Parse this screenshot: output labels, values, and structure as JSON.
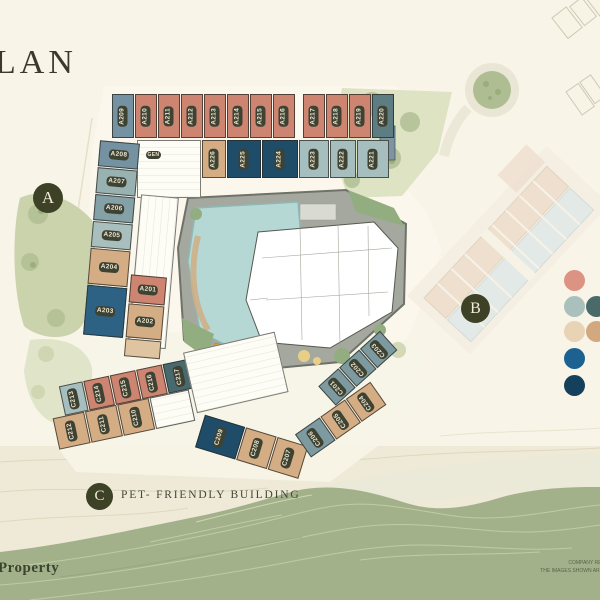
{
  "title": {
    "cropped_text": "LAN"
  },
  "brand": {
    "text": "Property"
  },
  "disclaimer": {
    "line1": "COMPANY RESERVES THE",
    "line2": "THE IMAGES SHOWN ARE COMPUTER"
  },
  "markers": {
    "a": {
      "label": "A"
    },
    "b": {
      "label": "B"
    },
    "c": {
      "label": "C",
      "note": "PET- FRIENDLY BUILDING"
    }
  },
  "legend": {
    "swatches": [
      {
        "name": "salmon",
        "hex": "#dd9383"
      },
      {
        "name": "light-blue",
        "hex": "#a9c0bd"
      },
      {
        "name": "dark-teal",
        "hex": "#4a6a6a"
      },
      {
        "name": "light-tan",
        "hex": "#e8d3b4"
      },
      {
        "name": "tan",
        "hex": "#d2a87f"
      },
      {
        "name": "blue",
        "hex": "#1d6190"
      },
      {
        "name": "navy",
        "hex": "#14405c"
      }
    ]
  },
  "building_a": {
    "top_row": [
      "A209",
      "A210",
      "A211",
      "A212",
      "A213",
      "A214",
      "A215",
      "A216",
      "A217",
      "A218",
      "A219",
      "A220"
    ],
    "second_row": [
      "A226",
      "A225",
      "A224",
      "A223",
      "A222",
      "A221"
    ],
    "west_column": [
      "A208",
      "A207",
      "A206",
      "A205",
      "A204",
      "A203"
    ],
    "inner_units": [
      "A201",
      "A202"
    ],
    "utility_room": "GEN"
  },
  "building_c": {
    "upper_row": [
      "C213",
      "C214",
      "C215",
      "C216",
      "C217"
    ],
    "lower_row": [
      "C212",
      "C211",
      "C210"
    ],
    "mid_row": [
      "C209",
      "C208",
      "C207"
    ],
    "east_upper_row": [
      "C201",
      "C202",
      "C203"
    ],
    "east_lower_row": [
      "C206",
      "C205",
      "C204"
    ]
  }
}
